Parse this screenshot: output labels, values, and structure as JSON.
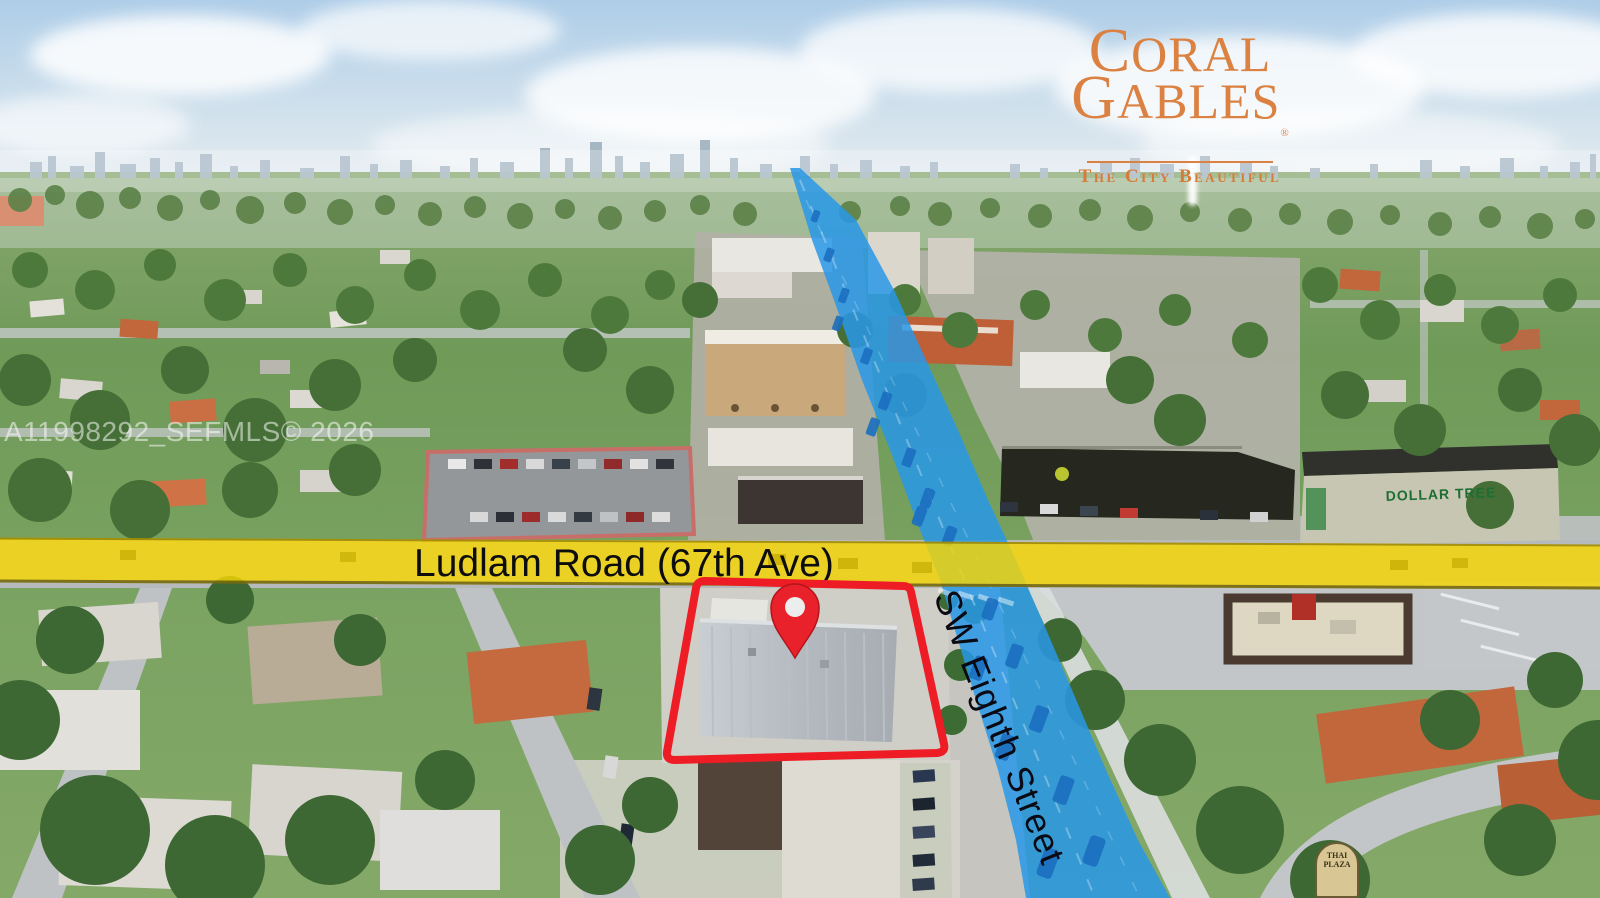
{
  "logo": {
    "line1": "CORAL",
    "line2": "GABLES",
    "registered": "®",
    "tagline": "The City Beautiful",
    "color": "#db8141"
  },
  "watermark": {
    "text": "A11998292_SEFMLS© 2026"
  },
  "roads": {
    "horizontal": {
      "label": "Ludlam Road (67th Ave)",
      "highlight_color": "#f7d602"
    },
    "vertical": {
      "label": "SW Eighth Street",
      "highlight_color": "#2f9ce8"
    }
  },
  "property": {
    "outline_color": "#ee1c24",
    "marker": "location-pin"
  },
  "signs": {
    "dollar_tree": "DOLLAR TREE",
    "thai_plaza": "THAI PLAZA"
  }
}
